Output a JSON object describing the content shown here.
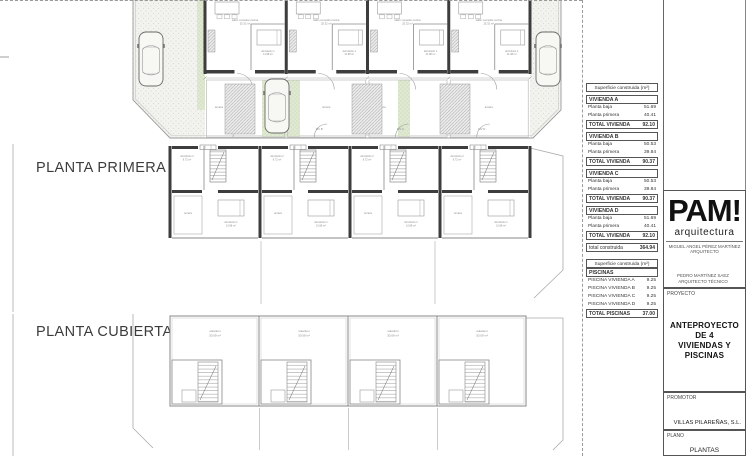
{
  "sections": {
    "first_floor": "PLANTA PRIMERA",
    "roof": "PLANTA CUBIERTA"
  },
  "plans": {
    "ground": {
      "living_label": "salón comedor-cocina",
      "living_area": "25.32 m²",
      "bedroom_label": "dormitorio 1",
      "bedroom_area": "11.98 m²",
      "terrace_label": "terraza",
      "gate_labels": [
        "MV A",
        "MV B",
        "MV C",
        "MV D"
      ]
    },
    "first": {
      "bedroom2_label": "dormitorio 2",
      "bedroom2_area": "9.72 m²",
      "bedroom1_label": "dormitorio 1",
      "bedroom1_area": "10.88 m²",
      "terrace_label": "terraza"
    },
    "roof": {
      "solarium_label": "solarium",
      "solarium_area": "30.09 m²"
    }
  },
  "tables": {
    "area": {
      "header": "Superficie construida (m²)",
      "blocks": [
        {
          "name": "VIVIENDA A",
          "r1l": "Planta baja",
          "r1v": "51.69",
          "r2l": "Planta primera",
          "r2v": "40.41",
          "tl": "TOTAL VIVIENDA",
          "tv": "92.10"
        },
        {
          "name": "VIVIENDA B",
          "r1l": "Planta baja",
          "r1v": "50.53",
          "r2l": "Planta primera",
          "r2v": "39.84",
          "tl": "TOTAL VIVIENDA",
          "tv": "90.37"
        },
        {
          "name": "VIVIENDA C",
          "r1l": "Planta baja",
          "r1v": "50.53",
          "r2l": "Planta primera",
          "r2v": "39.84",
          "tl": "TOTAL VIVIENDA",
          "tv": "90.37"
        },
        {
          "name": "VIVIENDA D",
          "r1l": "Planta baja",
          "r1v": "51.69",
          "r2l": "Planta primera",
          "r2v": "40.41",
          "tl": "TOTAL VIVIENDA",
          "tv": "92.10"
        }
      ],
      "grand_label": "total construida",
      "grand_value": "364.94"
    },
    "pools": {
      "header": "Superficie construida (m²)",
      "title": "PISCINAS",
      "rows": [
        {
          "label": "PISCINA VIVIENDA A",
          "value": "9.25"
        },
        {
          "label": "PISCINA VIVIENDA B",
          "value": "9.25"
        },
        {
          "label": "PISCINA VIVIENDA C",
          "value": "9.25"
        },
        {
          "label": "PISCINA VIVIENDA D",
          "value": "9.25"
        }
      ],
      "total_label": "TOTAL PISCINAS",
      "total_value": "37.00"
    }
  },
  "titleblock": {
    "logo": "PAM!",
    "logo_sub": "arquitectura",
    "architect_name": "MIGUEL ANGEL PÉREZ MARTÍNEZ",
    "architect_role": "ARQUITECTO",
    "tech_name": "PEDRO MARTÍNEZ SAEZ",
    "tech_role": "ARQUITECTO TÉCNICO",
    "project_label": "PROYECTO",
    "project_line1": "ANTEPROYECTO DE  4",
    "project_line2": "VIVIENDAS Y PISCINAS",
    "promoter_label": "PROMOTOR",
    "promoter_value": "VILLAS PILAREÑAS, S.L.",
    "plano_label": "PLANO",
    "plano_value": "PLANTAS"
  }
}
